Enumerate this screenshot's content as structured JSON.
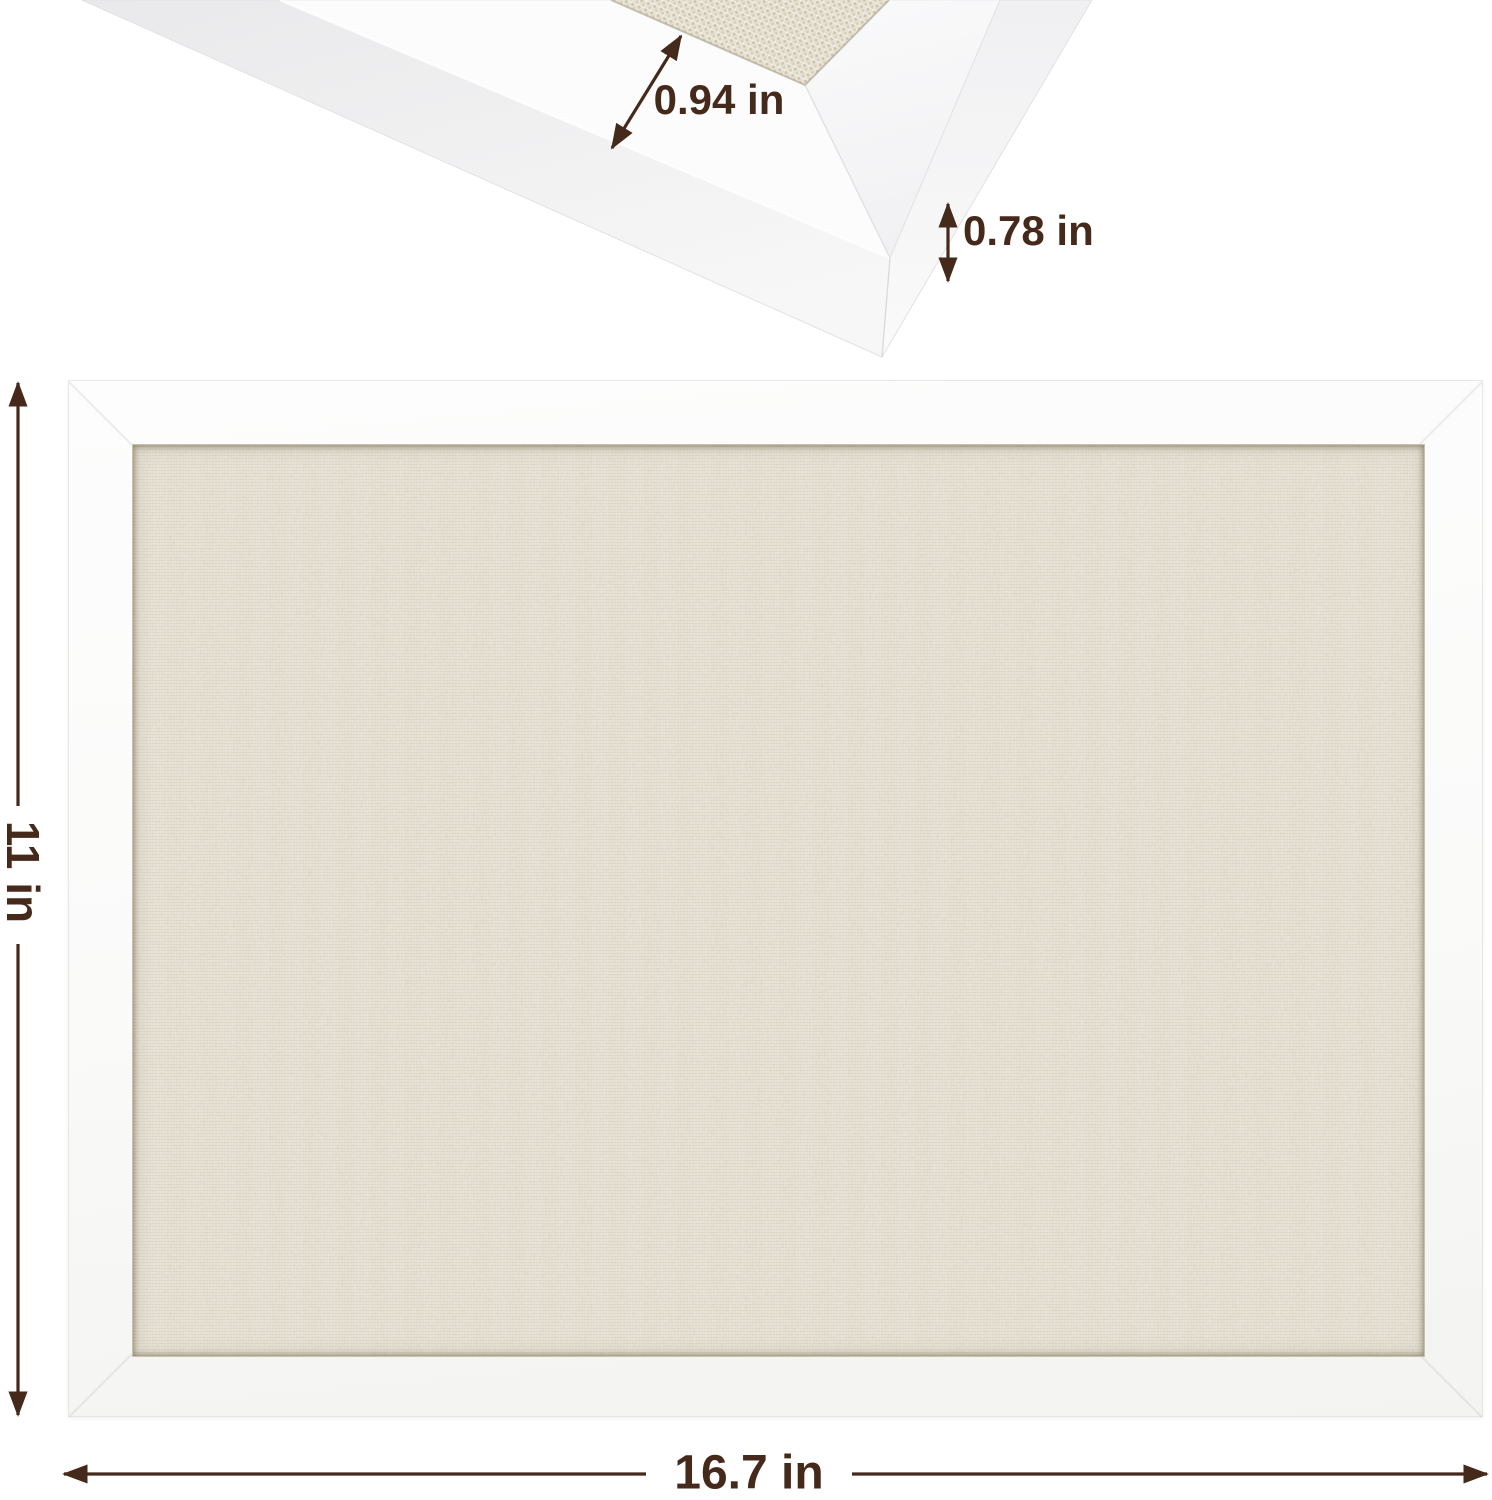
{
  "meta": {
    "description": "Product dimension diagram of a white-framed linen pin board",
    "background": "#ffffff"
  },
  "colors": {
    "dimension_ink": "#45291b",
    "frame_white": "#fbfbfc",
    "fabric_front": "#e8e3d5",
    "fabric_top_view": "#e5e0d1"
  },
  "corner_detail": {
    "face_width_label": "0.94 in",
    "edge_depth_label": "0.78 in"
  },
  "front_view": {
    "height_label": "11 in",
    "width_label": "16.7 in"
  }
}
